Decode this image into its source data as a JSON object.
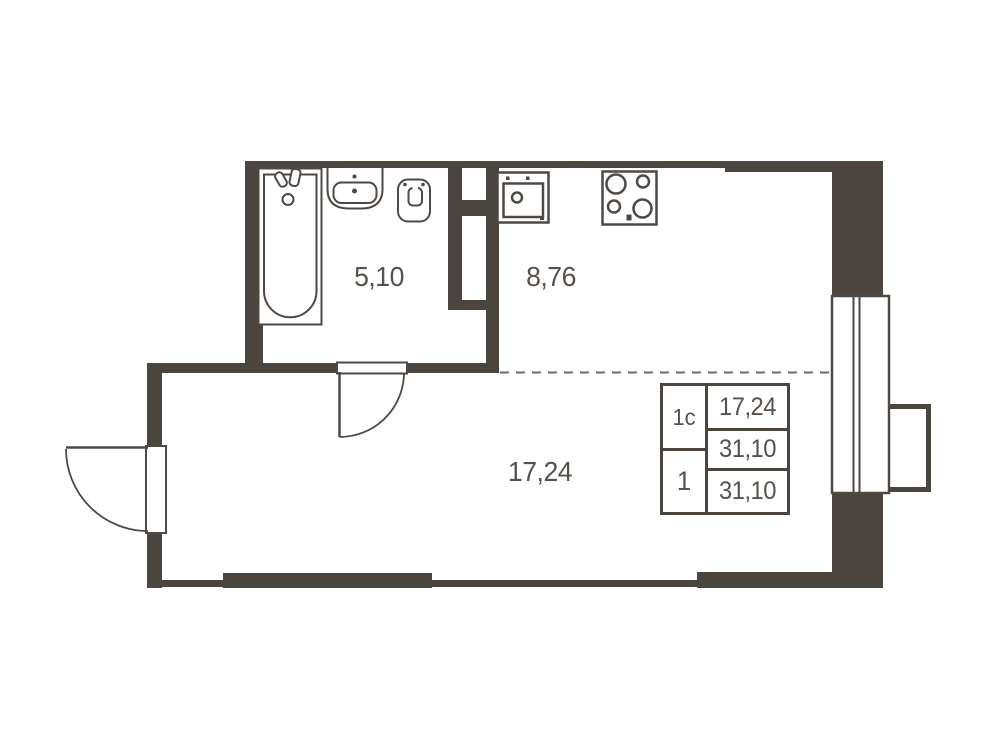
{
  "title": "studio-apartment-floor-plan",
  "colors": {
    "wall": "#4b4540",
    "fixture": "#4e4945",
    "text": "#56514c",
    "dash": "#6e6963",
    "bg": "#ffffff"
  },
  "rooms": {
    "bathroom": {
      "area": "5,10"
    },
    "kitchen": {
      "area": "8,76"
    },
    "living": {
      "area": "17,24"
    }
  },
  "info_table": {
    "apartment_type": "1с",
    "room_count": "1",
    "living_area": "17,24",
    "area": "31,10",
    "total_area": "31,10"
  },
  "fixtures": [
    "bathtub",
    "bathtub-faucet",
    "bathroom-sink",
    "toilet",
    "kitchen-sink",
    "stove",
    "entrance-door",
    "interior-door",
    "window",
    "balcony-basket"
  ]
}
